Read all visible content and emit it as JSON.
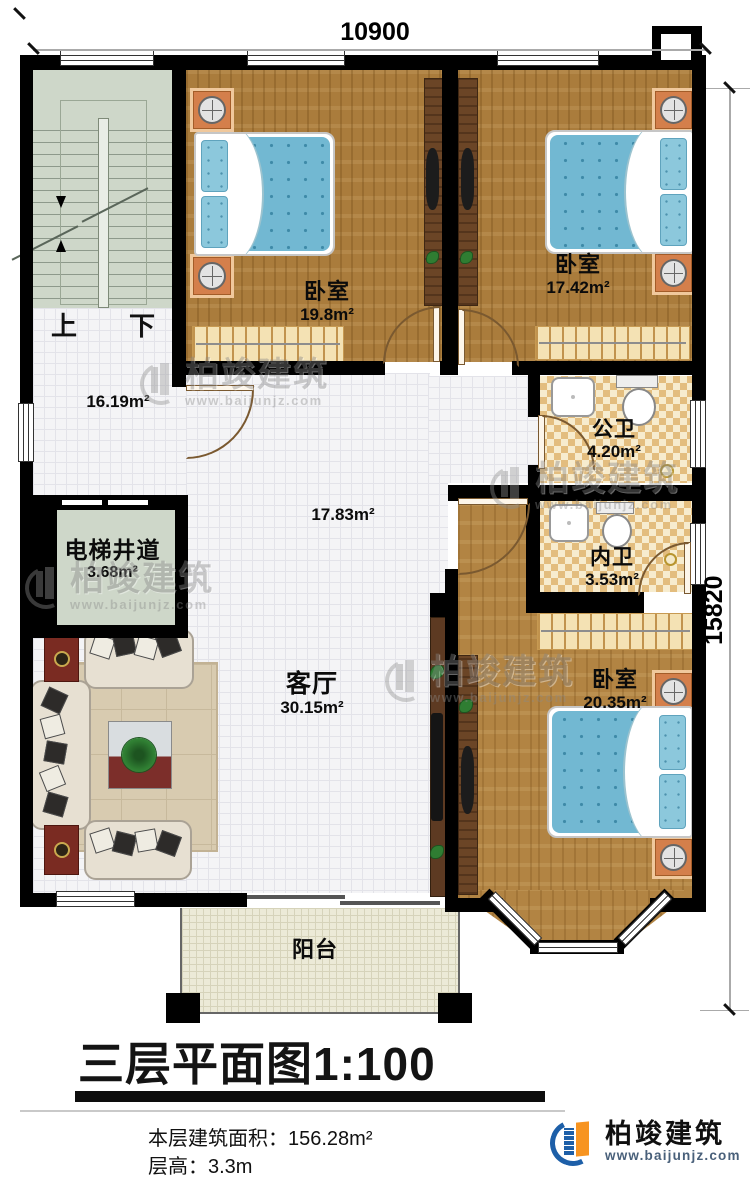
{
  "doc": {
    "title": "三层平面图",
    "scale": "1:100",
    "footer_line1": "本层建筑面积：156.28m²",
    "footer_line2": "层高：3.3m"
  },
  "dimensions": {
    "top": "10900",
    "right": "15820"
  },
  "rooms": {
    "bedroom1": {
      "name": "卧室",
      "area": "19.8m²"
    },
    "bedroom2": {
      "name": "卧室",
      "area": "17.42m²"
    },
    "bedroom3": {
      "name": "卧室",
      "area": "20.35m²"
    },
    "public_bath": {
      "name": "公卫",
      "area": "4.20m²"
    },
    "inner_bath": {
      "name": "内卫",
      "area": "3.53m²"
    },
    "hall": {
      "area": "16.19m²"
    },
    "corridor": {
      "area": "17.83m²"
    },
    "elevator": {
      "name": "电梯井道",
      "area": "3.68m²"
    },
    "living": {
      "name": "客厅",
      "area": "30.15m²"
    },
    "balcony": {
      "name": "阳台"
    }
  },
  "stairs": {
    "up": "上",
    "down": "下"
  },
  "watermark": {
    "name": "柏竣建筑",
    "url": "www.baijunjz.com"
  },
  "logo": {
    "name": "柏竣建筑",
    "url": "www.baijunjz.com"
  },
  "colors": {
    "wall": "#000000",
    "wood_floor": "#aa7c3c",
    "bath_checker": "#e3bd7e",
    "bed_blue": "#72b8d2",
    "stair_green": "#ced7c9",
    "logo_blue": "#1d5fa8",
    "logo_orange": "#f79421"
  }
}
